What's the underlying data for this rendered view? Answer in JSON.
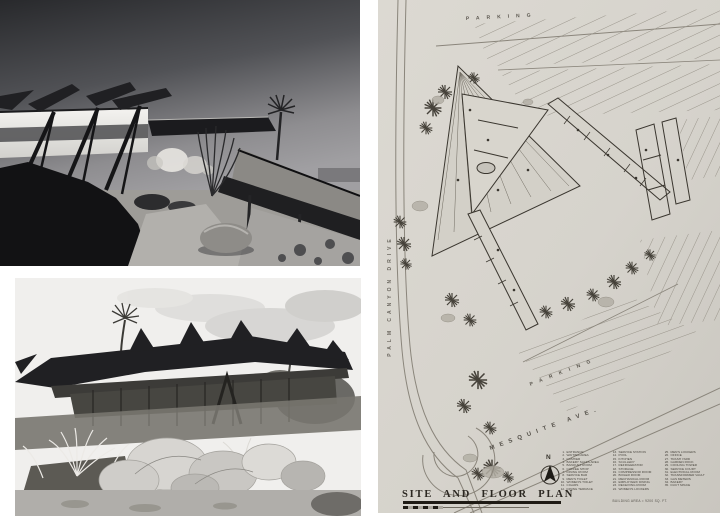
{
  "collage": {
    "photo_top": {
      "name": "night exterior photograph",
      "style": "black-and-white"
    },
    "photo_bottom": {
      "name": "daytime exterior photograph",
      "style": "black-and-white"
    }
  },
  "plan": {
    "sheet_title": "SITE AND FLOOR PLAN",
    "building_area_note": "BUILDING AREA = 9200 SQ. FT.",
    "north_label": "N",
    "streets": {
      "left_vertical": "PALM CANYON DRIVE",
      "bottom_diagonal": "MESQUITE AVE."
    },
    "parking_labels": {
      "top": "PARKING",
      "lower": "PARKING"
    },
    "legend": {
      "columns": [
        {
          "items": [
            {
              "n": "1.",
              "label": "ENTRANCE"
            },
            {
              "n": "2.",
              "label": "WAITING AREA"
            },
            {
              "n": "3.",
              "label": "CASHIER"
            },
            {
              "n": "4.",
              "label": "BAKERY SALES AREA"
            },
            {
              "n": "5.",
              "label": "BANQUET ROOM"
            },
            {
              "n": "6.",
              "label": "COFFEE SHOP"
            },
            {
              "n": "7.",
              "label": "DINING ROOM"
            },
            {
              "n": "8.",
              "label": "SERVICE BAR"
            },
            {
              "n": "9.",
              "label": "MEN'S TOILET"
            },
            {
              "n": "10.",
              "label": "WOMEN'S TOILET"
            },
            {
              "n": "11.",
              "label": "CIGARS"
            },
            {
              "n": "12.",
              "label": "DINING TERRACE"
            }
          ]
        },
        {
          "items": [
            {
              "n": "13.",
              "label": "SERVICE STATION"
            },
            {
              "n": "14.",
              "label": "POOL"
            },
            {
              "n": "15.",
              "label": "KITCHEN"
            },
            {
              "n": "16.",
              "label": "SCULLERY"
            },
            {
              "n": "17.",
              "label": "REFRIGERATOR"
            },
            {
              "n": "18.",
              "label": "STORAGE"
            },
            {
              "n": "19.",
              "label": "COMPRESSOR ROOM"
            },
            {
              "n": "20.",
              "label": "BOILER ROOM"
            },
            {
              "n": "21.",
              "label": "MECHANICAL ROOM"
            },
            {
              "n": "22.",
              "label": "EMPLOYEES' DINING"
            },
            {
              "n": "23.",
              "label": "RECEIVING ROOM"
            },
            {
              "n": "24.",
              "label": "WOMEN'S LOCKERS"
            }
          ]
        },
        {
          "items": [
            {
              "n": "25.",
              "label": "MEN'S LOCKERS"
            },
            {
              "n": "26.",
              "label": "OFFICE"
            },
            {
              "n": "27.",
              "label": "TRASH YARD"
            },
            {
              "n": "28.",
              "label": "GARDEN ROCK"
            },
            {
              "n": "29.",
              "label": "COOLING TOWER"
            },
            {
              "n": "30.",
              "label": "SERVICE COURT"
            },
            {
              "n": "31.",
              "label": "ELECTRICAL ROOM"
            },
            {
              "n": "32.",
              "label": "TRANSFORMER VAULT"
            },
            {
              "n": "33.",
              "label": "GAS METERS"
            },
            {
              "n": "34.",
              "label": "BAKERY"
            },
            {
              "n": "35.",
              "label": "DUCT SPACE"
            }
          ]
        }
      ]
    },
    "colors": {
      "paper": "#d8d5ce",
      "ink": "#3a362f",
      "title_ink": "#1f1b15"
    }
  }
}
